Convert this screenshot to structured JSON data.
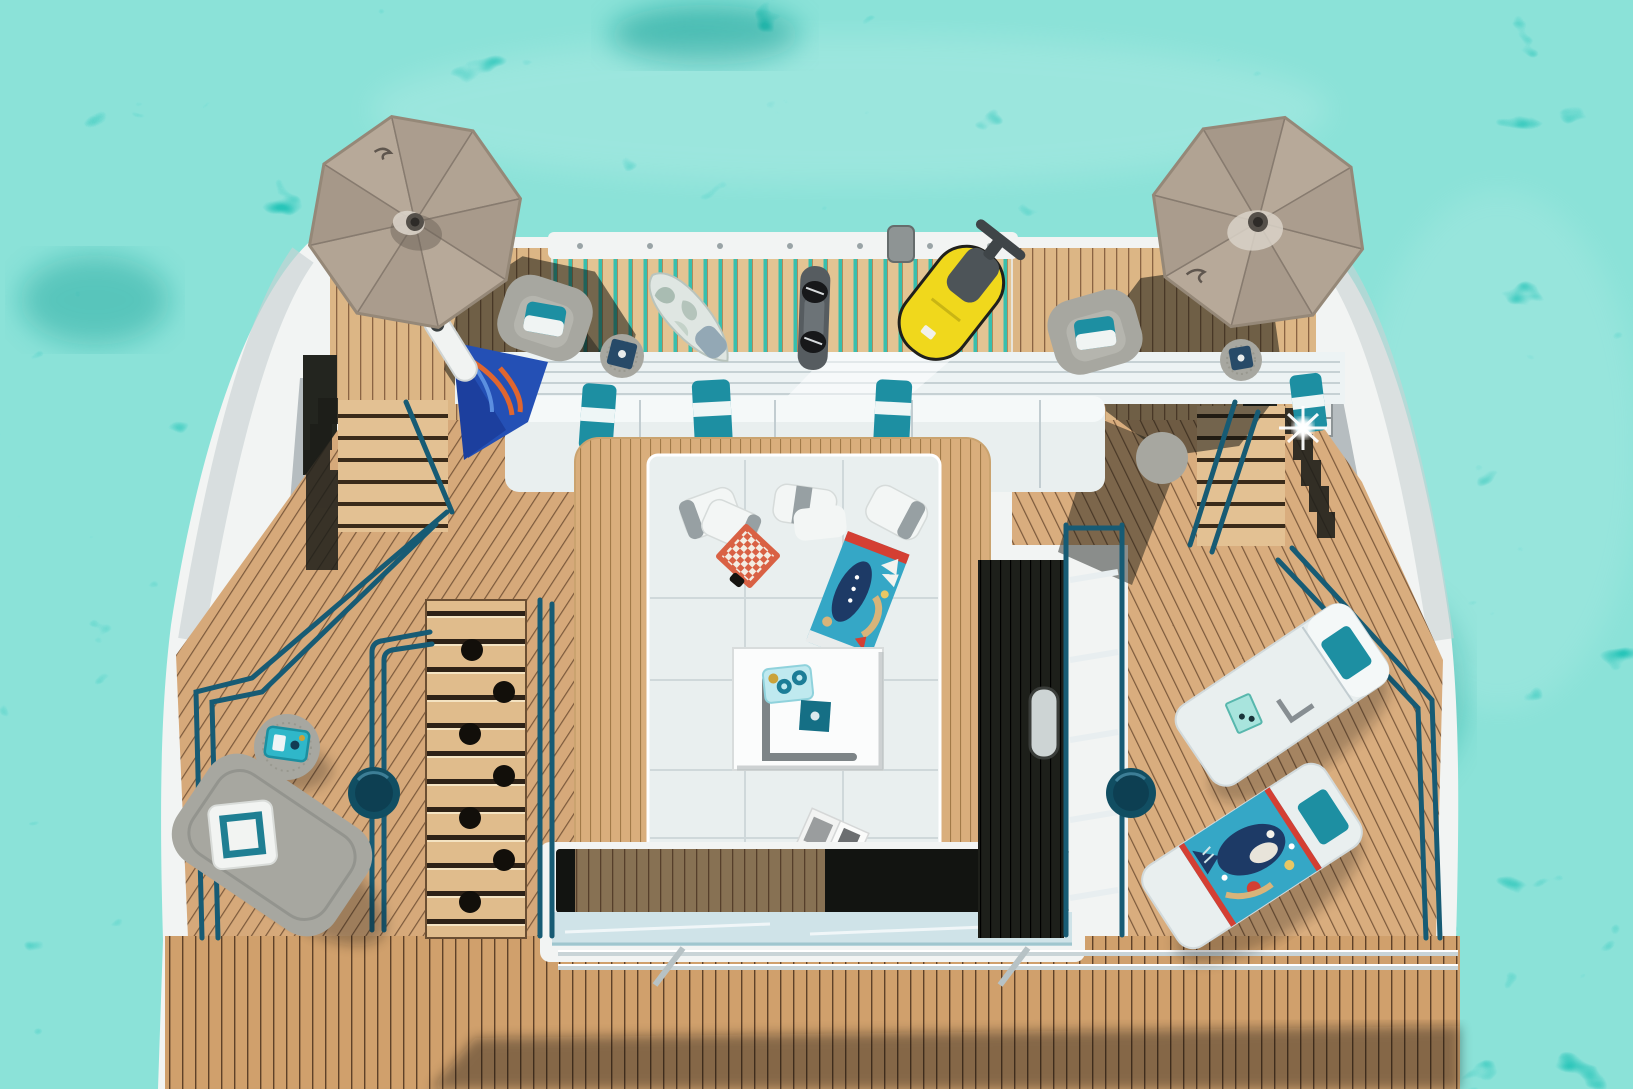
{
  "meta": {
    "title": "Top-down aerial photograph of a yacht aft sun deck anchored in turquoise water"
  },
  "palette": {
    "water_base": "#28c5b9",
    "water_light": "#9fefe0",
    "water_dark": "#0e9b92",
    "hull_white": "#f2f4f3",
    "hull_shadow": "#c9d2d4",
    "structure_gray": "#b6bdc0",
    "teak_top": "#dcb685",
    "teak_seam": "#8a6443",
    "slat_gap": "#37bfae",
    "slat_wood": "#e3c493",
    "deck_port": "#d6a97a",
    "deck_starboard": "#d9ad7e",
    "deck_bottom": "#d0a06c",
    "deck_bottom_seam": "#5f4128",
    "lounge_frame_teak": "#d9ae7c",
    "rail_teal": "#175b74",
    "chrome": "#c9d4d7",
    "sofa_white": "#e9efef",
    "cushion_seam": "#c2cdd1",
    "pillow_teal": "#1d8fa2",
    "pillow_white": "#f3f6f5",
    "pillow_gray_band": "#97a0a3",
    "furniture_gray": "#a7a7a0",
    "furniture_gray_dark": "#8f9089",
    "umbrella_taupe": "#b5a797",
    "umbrella_taupe_dark": "#a39586",
    "umbrella_rib": "#877b6f",
    "towel_blue": "#2450b5",
    "towel_blue_dark": "#1c3f9e",
    "towel_orange": "#e0662f",
    "towel_teal": "#35a7c6",
    "towel_red": "#d43f33",
    "towel_navy": "#1d3a66",
    "towel_sand": "#d8b47a",
    "checker_red": "#d96144",
    "checker_cream": "#f3ece2",
    "seabob_yellow": "#f0d81c",
    "seabob_gray": "#4d5458",
    "board_gray": "#565c60",
    "board_pale": "#dfe6e2",
    "board_camo": "#a9bcb2",
    "table_white": "#fbfcfc",
    "tray_blue": "#bfe9ef",
    "tray_teal_dark": "#156f85",
    "well_dark": "#191b17",
    "glass_blue": "#cfe3e8",
    "side_table_teal": "#114e62",
    "shadow_dark": "#0b0f0e"
  },
  "scene": {
    "objects": [
      {
        "id": "water",
        "label": "Turquoise sea water with sun caustics"
      },
      {
        "id": "hull",
        "label": "White yacht stern hull seen from above"
      },
      {
        "id": "swim-platform",
        "label": "Teak slatted aft platform with water toys"
      },
      {
        "id": "umbrella-port",
        "label": "Taupe octagonal parasol, port side"
      },
      {
        "id": "umbrella-starboard",
        "label": "Taupe octagonal parasol, starboard side"
      },
      {
        "id": "paddleboard",
        "label": "Grey camouflage stand-up paddleboard"
      },
      {
        "id": "wakeboard",
        "label": "Dark grey wakeboard with bindings"
      },
      {
        "id": "seabob",
        "label": "Yellow seabob underwater scooter"
      },
      {
        "id": "aft-sofa",
        "label": "Long white aft sofa with teal towels"
      },
      {
        "id": "lounge",
        "label": "Central white sunpad lounge framed in teak"
      },
      {
        "id": "checkerboard",
        "label": "Red and white checkers board"
      },
      {
        "id": "towel-center",
        "label": "Colourful printed beach towel on sunpad"
      },
      {
        "id": "coffee-table",
        "label": "White low table with drink trays"
      },
      {
        "id": "magazine",
        "label": "Open magazine on sunpad"
      },
      {
        "id": "armchair-port",
        "label": "Grey armchair under port parasol"
      },
      {
        "id": "armchair-starboard",
        "label": "Grey armchair under starboard parasol"
      },
      {
        "id": "daybed-port",
        "label": "Grey daybed with white pillow, port deck"
      },
      {
        "id": "loungers-starboard",
        "label": "Two white sun loungers, starboard deck"
      },
      {
        "id": "fish-towel",
        "label": "Fish-print beach towel on lounger"
      },
      {
        "id": "stairs",
        "label": "Teak deck stairs"
      },
      {
        "id": "railings",
        "label": "Petrol-blue and chrome deck railings"
      },
      {
        "id": "side-tables",
        "label": "Round petrol-blue side tables"
      }
    ]
  }
}
